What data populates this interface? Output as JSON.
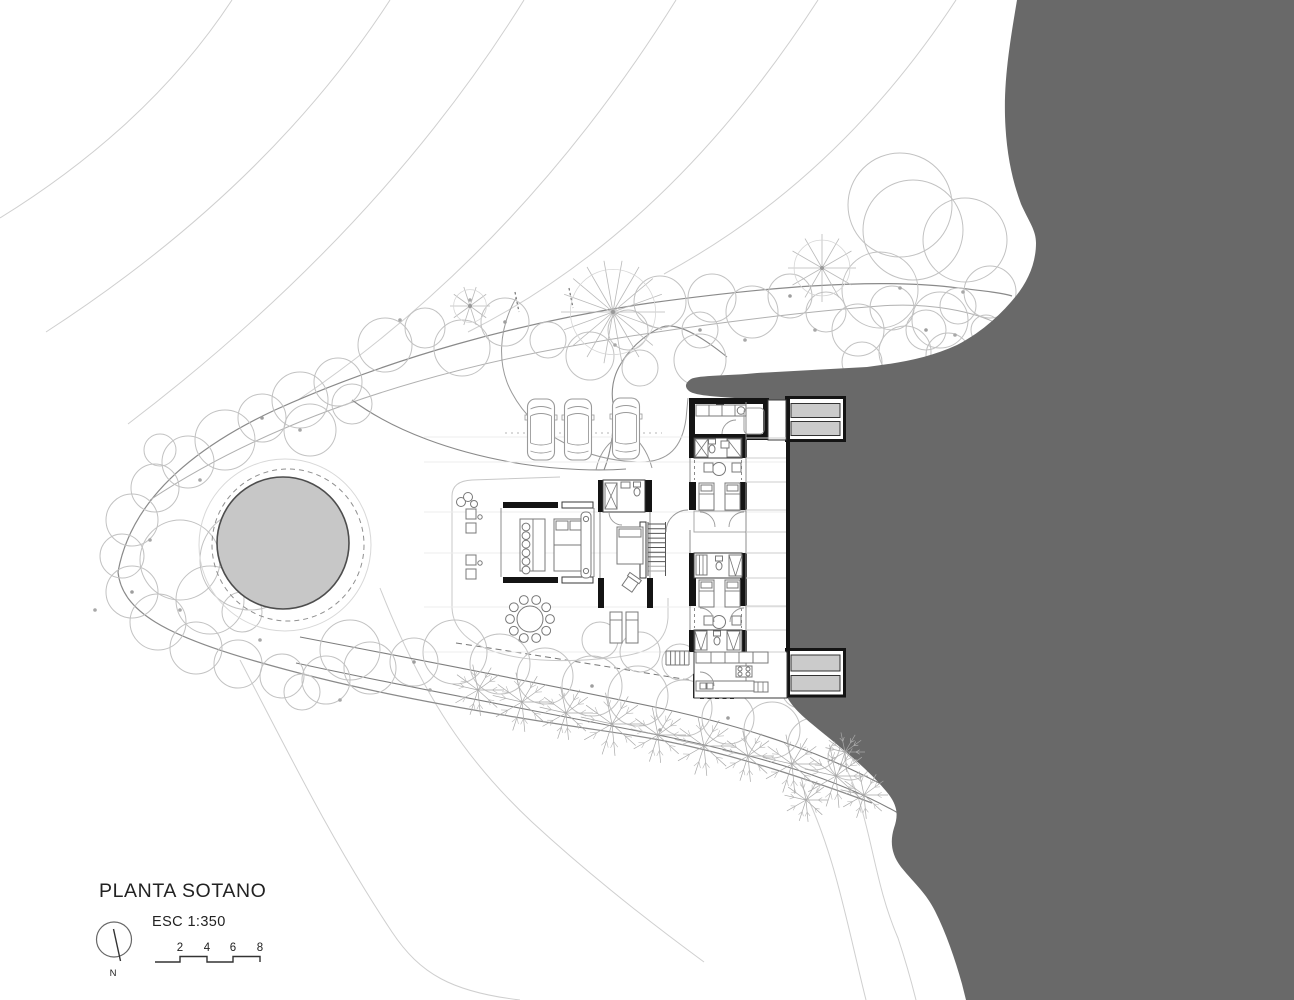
{
  "title_block": {
    "title": "PLANTA SOTANO",
    "scale_label": "ESC 1:350",
    "north_label": "N",
    "scale_bar": {
      "ticks": [
        "2",
        "4",
        "6",
        "8"
      ]
    }
  },
  "colors": {
    "terrain_shadow": "#696969",
    "pool_water": "#c7c7c7",
    "planter_fill": "#cbcbcb",
    "wall": "#141414",
    "site_line": "#8a8a8a",
    "vegetation_line": "#c2c2c2",
    "furniture_line": "#787878",
    "text": "#222222"
  }
}
